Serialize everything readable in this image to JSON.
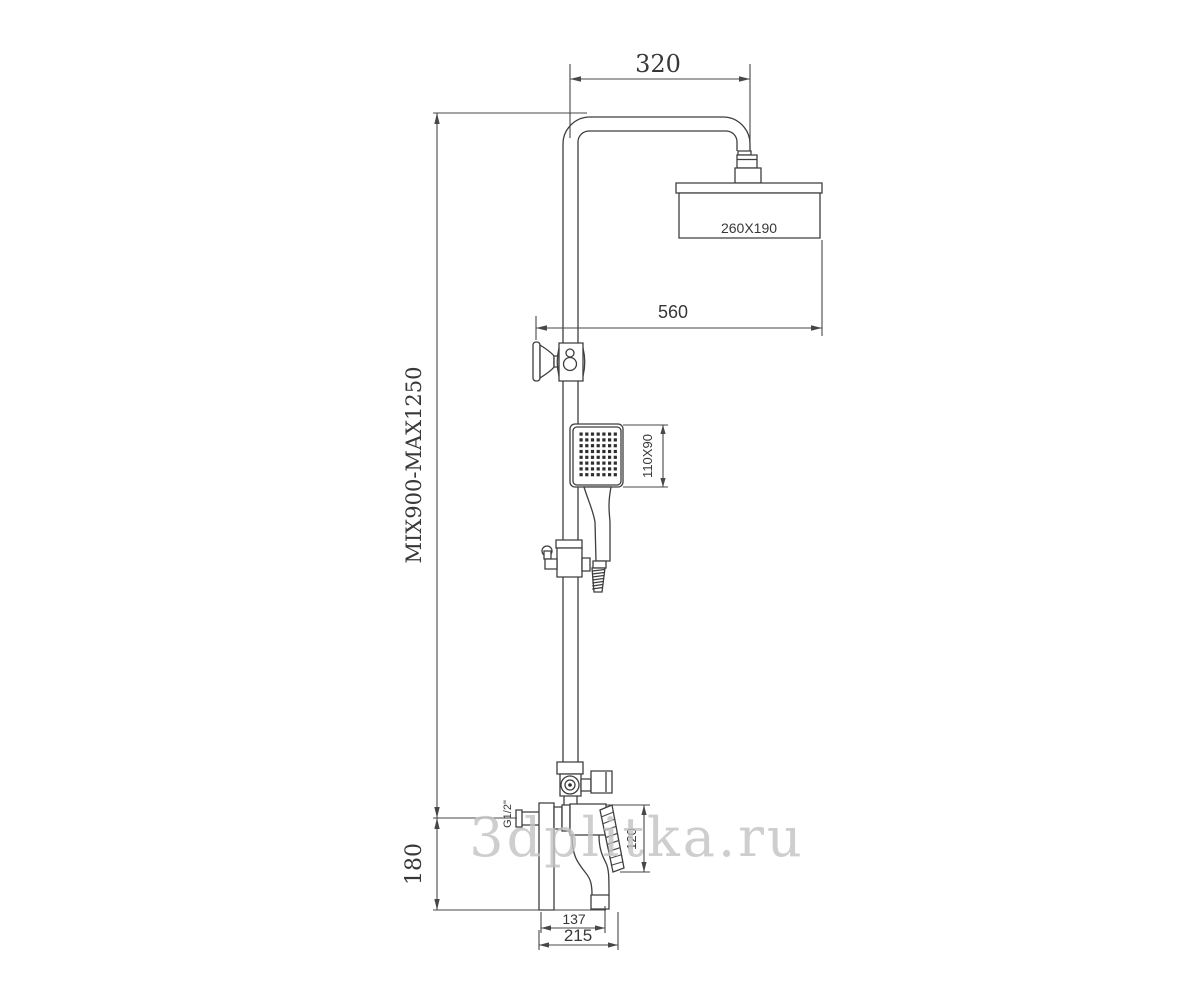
{
  "meta": {
    "description": "shower-column technical drawing",
    "background_color": "#ffffff",
    "line_color": "#3e3e3e",
    "text_color": "#383838",
    "watermark_color": "#c3c3c3"
  },
  "watermark": {
    "text": "3dplitka.ru"
  },
  "dimensions": {
    "arm_width": "320",
    "head_size": "260X190",
    "head_offset": "560",
    "column_height": "MIX900-MAX1250",
    "handshower_size": "110X90",
    "inlet_thread": "G1/2\"",
    "inlet_height": "180",
    "mixer_height": "120",
    "spout_reach": "137",
    "mixer_width": "215"
  }
}
